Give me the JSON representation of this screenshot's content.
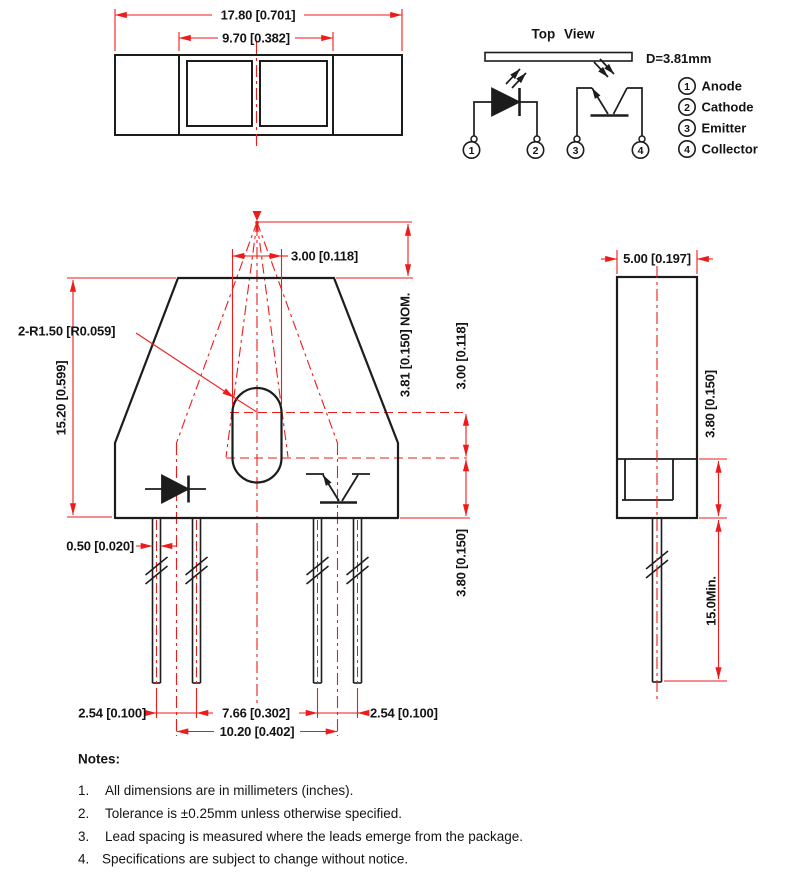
{
  "colors": {
    "dimension_red": "#ee1b1b",
    "line_black": "#1c1c1c"
  },
  "top_package_view": {
    "dim_overall_width": "17.80 [0.701]",
    "dim_window_width": "9.70 [0.382]"
  },
  "schematic": {
    "title": "Top View",
    "distance_label": "D=3.81mm",
    "pins": [
      {
        "number": "1",
        "label": "Anode"
      },
      {
        "number": "2",
        "label": "Cathode"
      },
      {
        "number": "3",
        "label": "Emitter"
      },
      {
        "number": "4",
        "label": "Collector"
      }
    ]
  },
  "front_view": {
    "dim_slot_width": "3.00 [0.118]",
    "dim_focal_distance": "3.81 [0.150] NOM.",
    "radius_label": "2-R1.50 [R0.059]",
    "dim_body_height": "15.20 [0.599]",
    "dim_slot_center_to_step": "3.00 [0.118]",
    "dim_step_to_base": "3.80 [0.150]",
    "dim_lead_thickness": "0.50 [0.020]",
    "dim_pitch_left": "2.54 [0.100]",
    "dim_inner_span": "7.66 [0.302]",
    "dim_pitch_right": "2.54 [0.100]",
    "dim_center_span": "10.20 [0.402]"
  },
  "side_view": {
    "dim_width": "5.00 [0.197]",
    "dim_base_height": "3.80 [0.150]",
    "dim_lead_length_min": "15.0Min."
  },
  "notes": {
    "title": "Notes:",
    "items": [
      {
        "num": "1.",
        "text": "All dimensions are in millimeters (inches)."
      },
      {
        "num": "2.",
        "text": "Tolerance is ±0.25mm unless otherwise specified."
      },
      {
        "num": "3.",
        "text": "Lead spacing is measured where the leads emerge from the package."
      },
      {
        "num": "4.",
        "text": "Specifications are subject to change without notice."
      }
    ]
  }
}
